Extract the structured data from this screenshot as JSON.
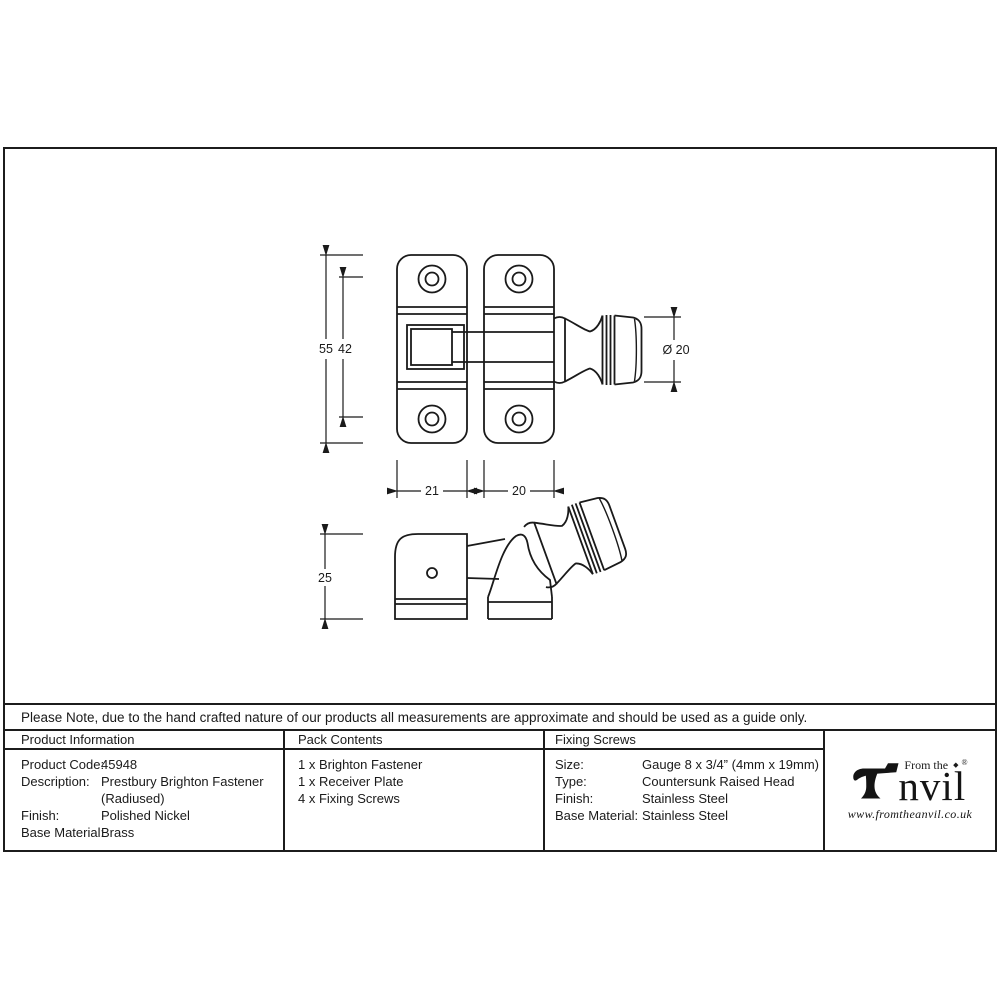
{
  "note": "Please Note, due to the hand crafted nature of our products all measurements are approximate and should be used as a guide only.",
  "product_information": {
    "header": "Product Information",
    "rows": [
      {
        "label": "Product Code:",
        "value": "45948"
      },
      {
        "label": "Description:",
        "value": "Prestbury Brighton Fastener"
      },
      {
        "label": "",
        "value": "(Radiused)"
      },
      {
        "label": "Finish:",
        "value": "Polished Nickel"
      },
      {
        "label": "Base Material:",
        "value": "Brass"
      }
    ]
  },
  "pack_contents": {
    "header": "Pack Contents",
    "items": [
      "1 x Brighton Fastener",
      "1 x Receiver Plate",
      "4 x Fixing Screws"
    ]
  },
  "fixing_screws": {
    "header": "Fixing Screws",
    "rows": [
      {
        "label": "Size:",
        "value": "Gauge 8 x 3/4” (4mm x 19mm)"
      },
      {
        "label": "Type:",
        "value": "Countersunk Raised Head"
      },
      {
        "label": "Finish:",
        "value": "Stainless Steel"
      },
      {
        "label": "Base Material:",
        "value": "Stainless Steel"
      }
    ]
  },
  "brand": {
    "prefix": "From the",
    "diamond": "◆",
    "registered": "®",
    "name_rest": "nvil",
    "website": "www.fromtheanvil.co.uk"
  },
  "drawing": {
    "dimensions": {
      "overall_height": "55",
      "hole_spacing": "42",
      "plate_width_left": "21",
      "plate_width_right": "20",
      "knob_diameter": "Ø 20",
      "receiver_height": "25"
    },
    "colors": {
      "line": "#1a1a1a",
      "background": "#ffffff"
    }
  }
}
